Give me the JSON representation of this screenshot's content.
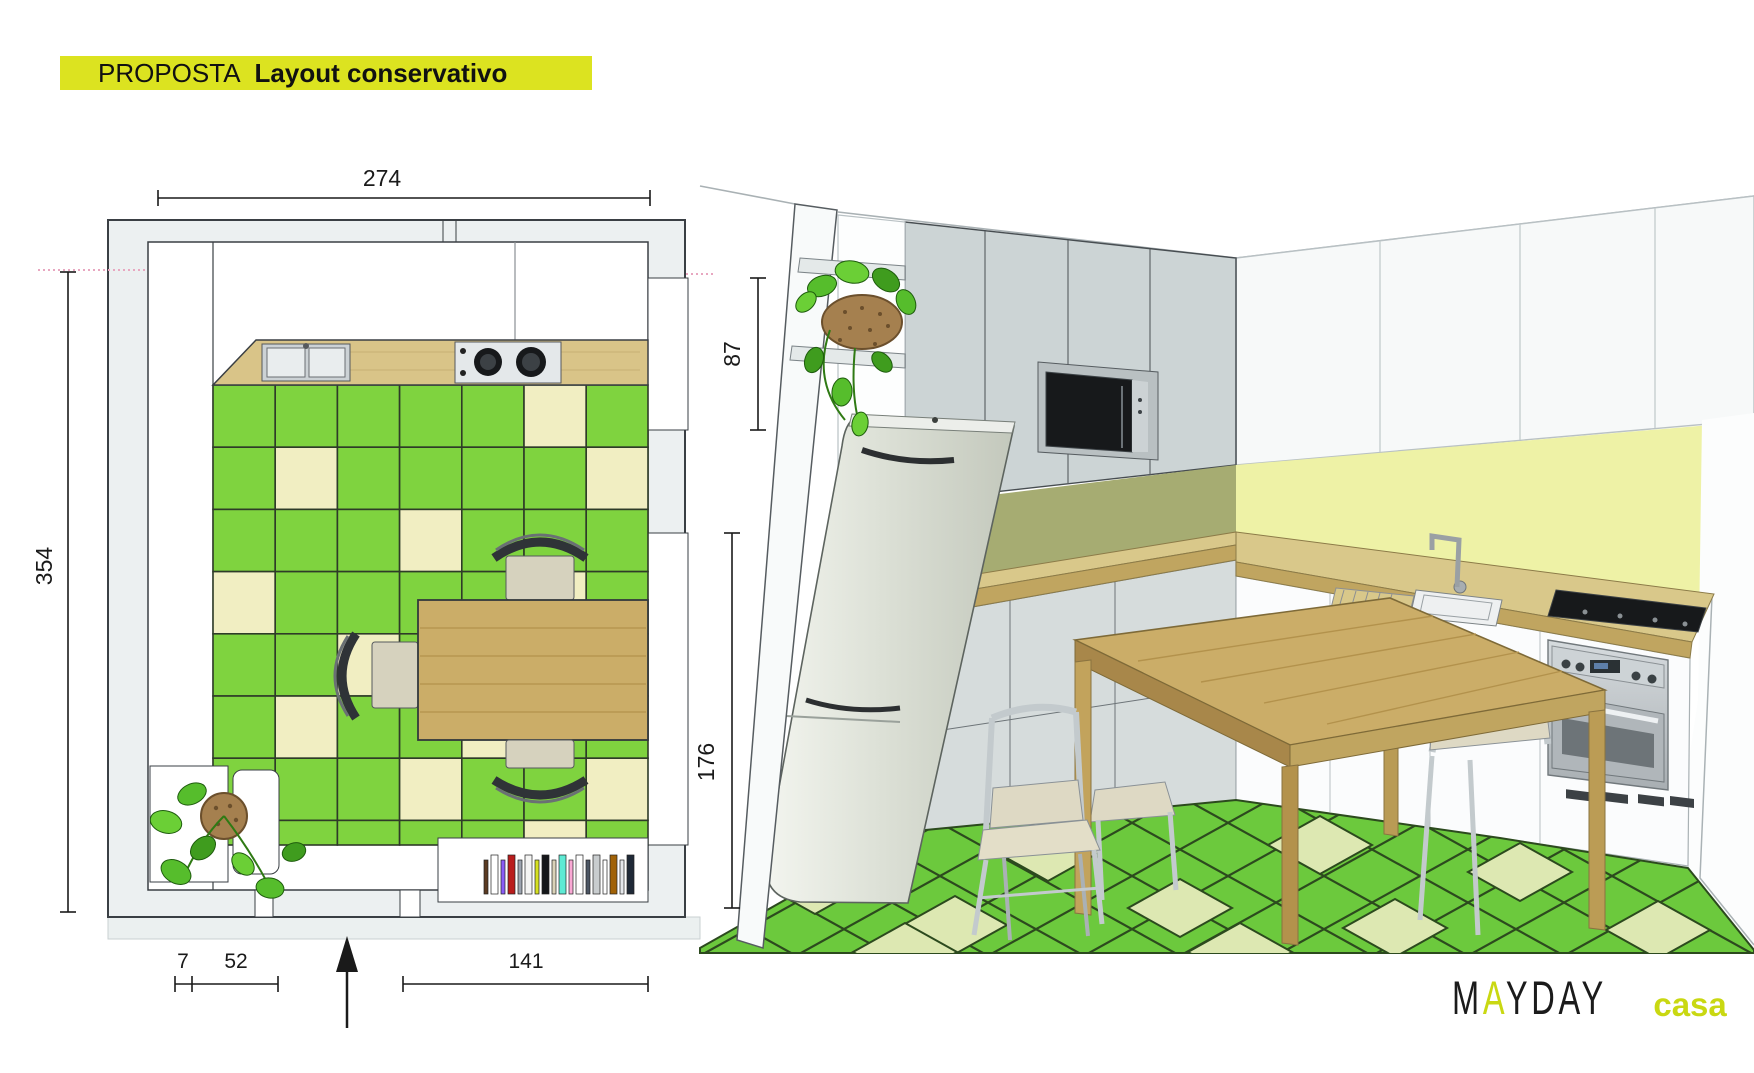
{
  "title": {
    "eyebrow": "PROPOSTA",
    "name": "Layout conservativo",
    "highlight": "#dce320"
  },
  "floor_plan": {
    "dims": {
      "top": "274",
      "left": "354",
      "right_upper": "87",
      "right_lower": "176",
      "bottom_a": "7",
      "bottom_b": "52",
      "bottom_c": "141"
    },
    "floor_pattern": {
      "rows": [
        "GGGGGCG",
        "GCGGGGC",
        "GGGCGGG",
        "CGGGGCG",
        "GGCGGGC",
        "GCGGCGG",
        "GGGCGGC",
        "GGGGGCG"
      ]
    },
    "shelf_strip_colors": [
      "#5b3a21",
      "#ffffff",
      "#8b5cf6",
      "#b91c1c",
      "#9ca3af",
      "#f5f5f4",
      "#d6e021",
      "#15171a",
      "#d9d2b8",
      "#5eead4",
      "#f9a8d4",
      "#ffffff",
      "#4b5563",
      "#c8ccce",
      "#ffffff",
      "#a16207",
      "#e5e7eb",
      "#1f2937",
      "#eab308",
      "#fca5a5",
      "#93c5fd",
      "#dddddd"
    ]
  },
  "palette": {
    "plan_wall": "#ecf0f1",
    "plan_line": "#3a3f44",
    "tile_green": "#7fd33f",
    "tile_cream": "#f1eec2",
    "tile_line": "#2e3b28",
    "wood": "#d9c488",
    "wood_dark": "#c0a560",
    "table_wood": "#cbad68",
    "olive_backsplash": "#a6ac72",
    "yellow_backsplash": "#eef2a6",
    "cabinet_gray": "#ccd4d5",
    "cabinet_white": "#f7f9f9",
    "counter_wood": "#d9c88a",
    "floor_green": "#6cc93d",
    "floor_cream": "#dde8b2",
    "floor_line": "#2c4a1e",
    "fridge": "#e2e5dd",
    "leaf_green": "#56bd2c",
    "pot_brown": "#a5804f",
    "section_pink": "#e8a7c0",
    "dim_line": "#1a1a1a"
  },
  "logo": {
    "letters": [
      {
        "ch": "M",
        "c": "#1b1b1b"
      },
      {
        "ch": "A",
        "c": "#c9d812"
      },
      {
        "ch": "Y",
        "c": "#1b1b1b"
      },
      {
        "ch": "D",
        "c": "#1b1b1b"
      },
      {
        "ch": "A",
        "c": "#1b1b1b"
      },
      {
        "ch": "Y",
        "c": "#1b1b1b"
      }
    ],
    "sub": "casa",
    "sub_color": "#c9d812"
  }
}
